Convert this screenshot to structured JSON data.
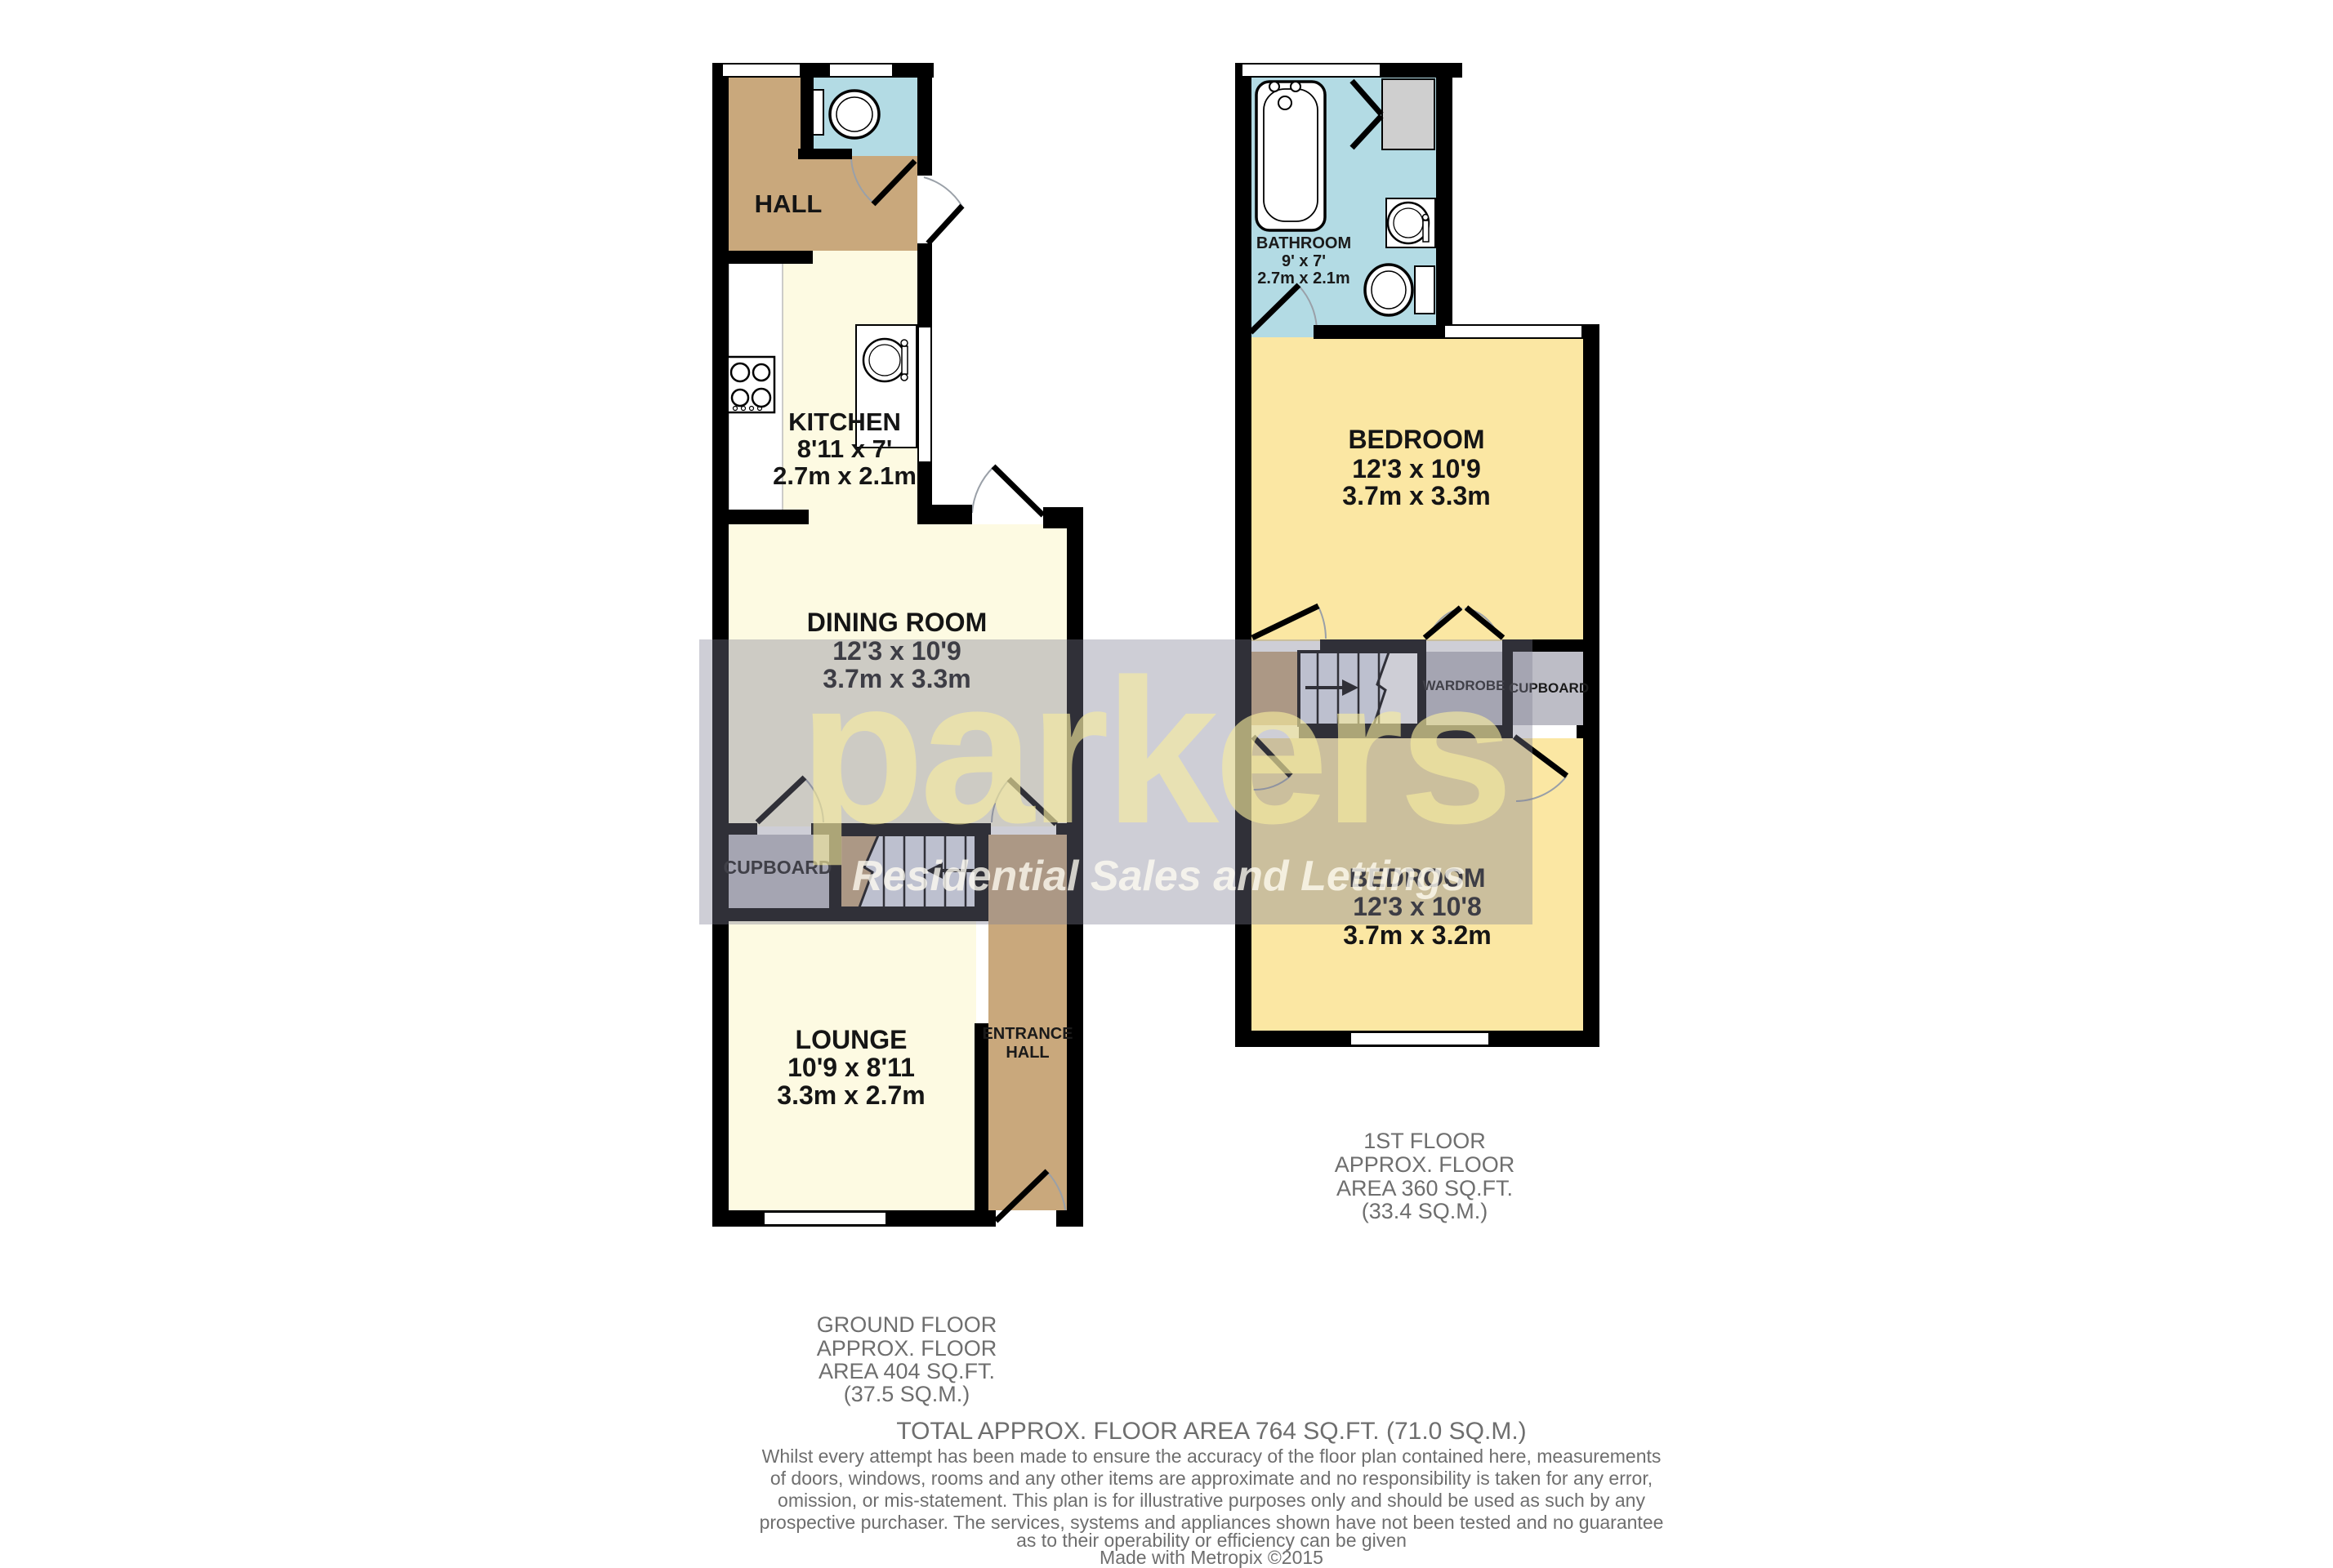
{
  "brand": {
    "name": "parkers",
    "tagline": "Residential Sales and Lettings"
  },
  "ground_floor": {
    "hall": "HALL",
    "kitchen": [
      "KITCHEN",
      "8'11 x 7'",
      "2.7m x 2.1m"
    ],
    "dining_room": [
      "DINING ROOM",
      "12'3 x 10'9",
      "3.7m x 3.3m"
    ],
    "cupboard": "CUPBOARD",
    "lounge": [
      "LOUNGE",
      "10'9 x 8'11",
      "3.3m x 2.7m"
    ],
    "entrance_hall": [
      "ENTRANCE",
      "HALL"
    ],
    "caption": [
      "GROUND FLOOR",
      "APPROX. FLOOR",
      "AREA 404 SQ.FT.",
      "(37.5 SQ.M.)"
    ]
  },
  "first_floor": {
    "bathroom": [
      "BATHROOM",
      "9' x 7'",
      "2.7m x 2.1m"
    ],
    "bedroom_front": [
      "BEDROOM",
      "12'3 x 10'9",
      "3.7m x 3.3m"
    ],
    "bedroom_back": [
      "BEDROOM",
      "12'3 x 10'8",
      "3.7m x 3.2m"
    ],
    "wardrobe": "WARDROBE",
    "cupboard": "CUPBOARD",
    "caption": [
      "1ST FLOOR",
      "APPROX. FLOOR",
      "AREA 360 SQ.FT.",
      "(33.4 SQ.M.)"
    ]
  },
  "footer": {
    "total": "TOTAL APPROX. FLOOR AREA 764 SQ.FT. (71.0 SQ.M.)",
    "disclaimer": [
      "Whilst every attempt has been made to ensure the accuracy of the floor plan contained here, measurements",
      "of doors, windows, rooms and any other items are approximate and no responsibility is taken for any error,",
      "omission, or mis-statement. This plan is for illustrative purposes only and should be used as such by any",
      "prospective purchaser. The services, systems and appliances shown have not been tested and no guarantee",
      "as to their operability or efficiency can be given"
    ],
    "credit": "Made with Metropix ©2015"
  },
  "colors": {
    "hall_tan": "#C9A87C",
    "bathroom_blue": "#B3DBE4",
    "cream": "#FDFAE2",
    "bedroom_yellow": "#FBE7A3",
    "storage_gray": "#BDBDC6",
    "stair_fill": "#E4E9F4",
    "wall": "#000000",
    "caption_gray": "#6E6E6E",
    "watermark_yellow": "#F6ECA8",
    "watermark_band": "#7D7D94"
  }
}
